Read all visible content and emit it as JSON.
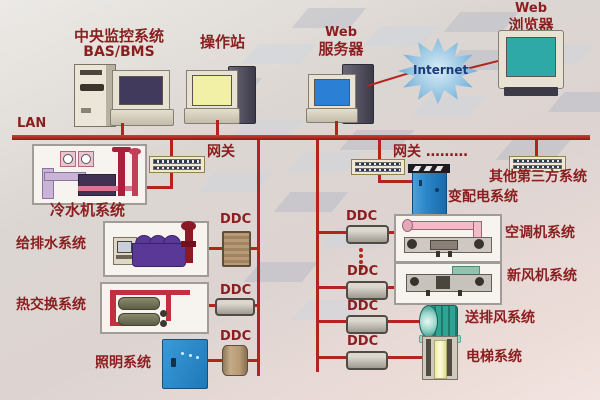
{
  "top": {
    "bas_title": "中央监控系统",
    "bas_subtitle": "BAS/BMS",
    "operator": "操作站",
    "web_server_en": "Web",
    "web_server_cn": "服务器",
    "internet": "Internet",
    "browser_en": "Web",
    "browser_cn": "浏览器"
  },
  "network": {
    "lan": "LAN",
    "gateway_left": "网关",
    "gateway_mid": "网关 ………",
    "third_party": "其他第三方系统",
    "ddc": "DDC"
  },
  "systems": {
    "chiller": "冷水机系统",
    "water_supply": "给排水系统",
    "heat_exchange": "热交换系统",
    "lighting": "照明系统",
    "power_dist": "变配电系统",
    "air_handling": "空调机系统",
    "fresh_air": "新风机系统",
    "supply_exhaust_fan": "送排风系统",
    "elevator": "电梯系统"
  },
  "colors": {
    "line_red": "#b3241f",
    "label_red": "#8b1e1e",
    "internet_blue": "#7db6dc",
    "cabinet_blue": "#2b86c8",
    "screen_yellow": "#f2efa6",
    "screen_teal": "#2fa8a8",
    "screen_blue": "#2b7fd4",
    "screen_purple": "#423a5c"
  }
}
